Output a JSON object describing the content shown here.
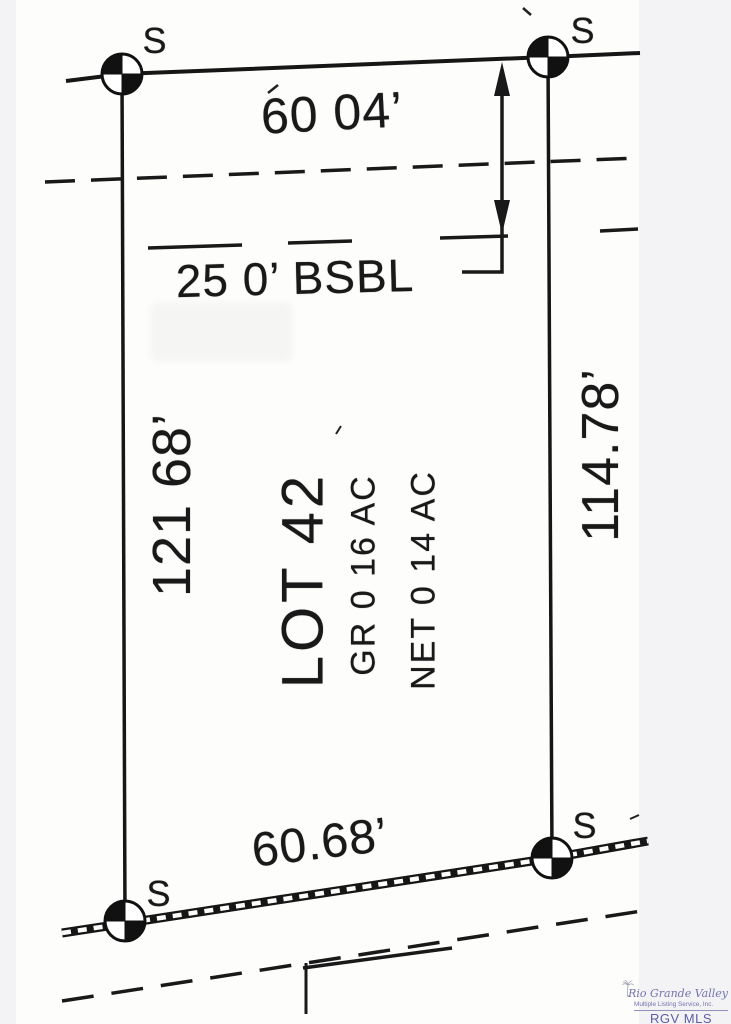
{
  "plat": {
    "lot_label": "LOT 42",
    "gross_area": "GR  0 16 AC",
    "net_area": "NET  0 14 AC",
    "dim_top": "60 04’",
    "dim_left": "121 68’",
    "dim_right": "114.78’",
    "dim_bottom": "60.68’",
    "setback_label": "25 0’ BSBL",
    "marker_label": "S"
  },
  "watermark": {
    "name_script": "Rio Grande Valley",
    "subtitle": "Multiple Listing Service, Inc.",
    "abbr": "RGV MLS"
  },
  "colors": {
    "ink": "#191919",
    "paper": "#fdfdfc",
    "background": "#f3f3f5",
    "watermark_purple": "#7473ae"
  }
}
